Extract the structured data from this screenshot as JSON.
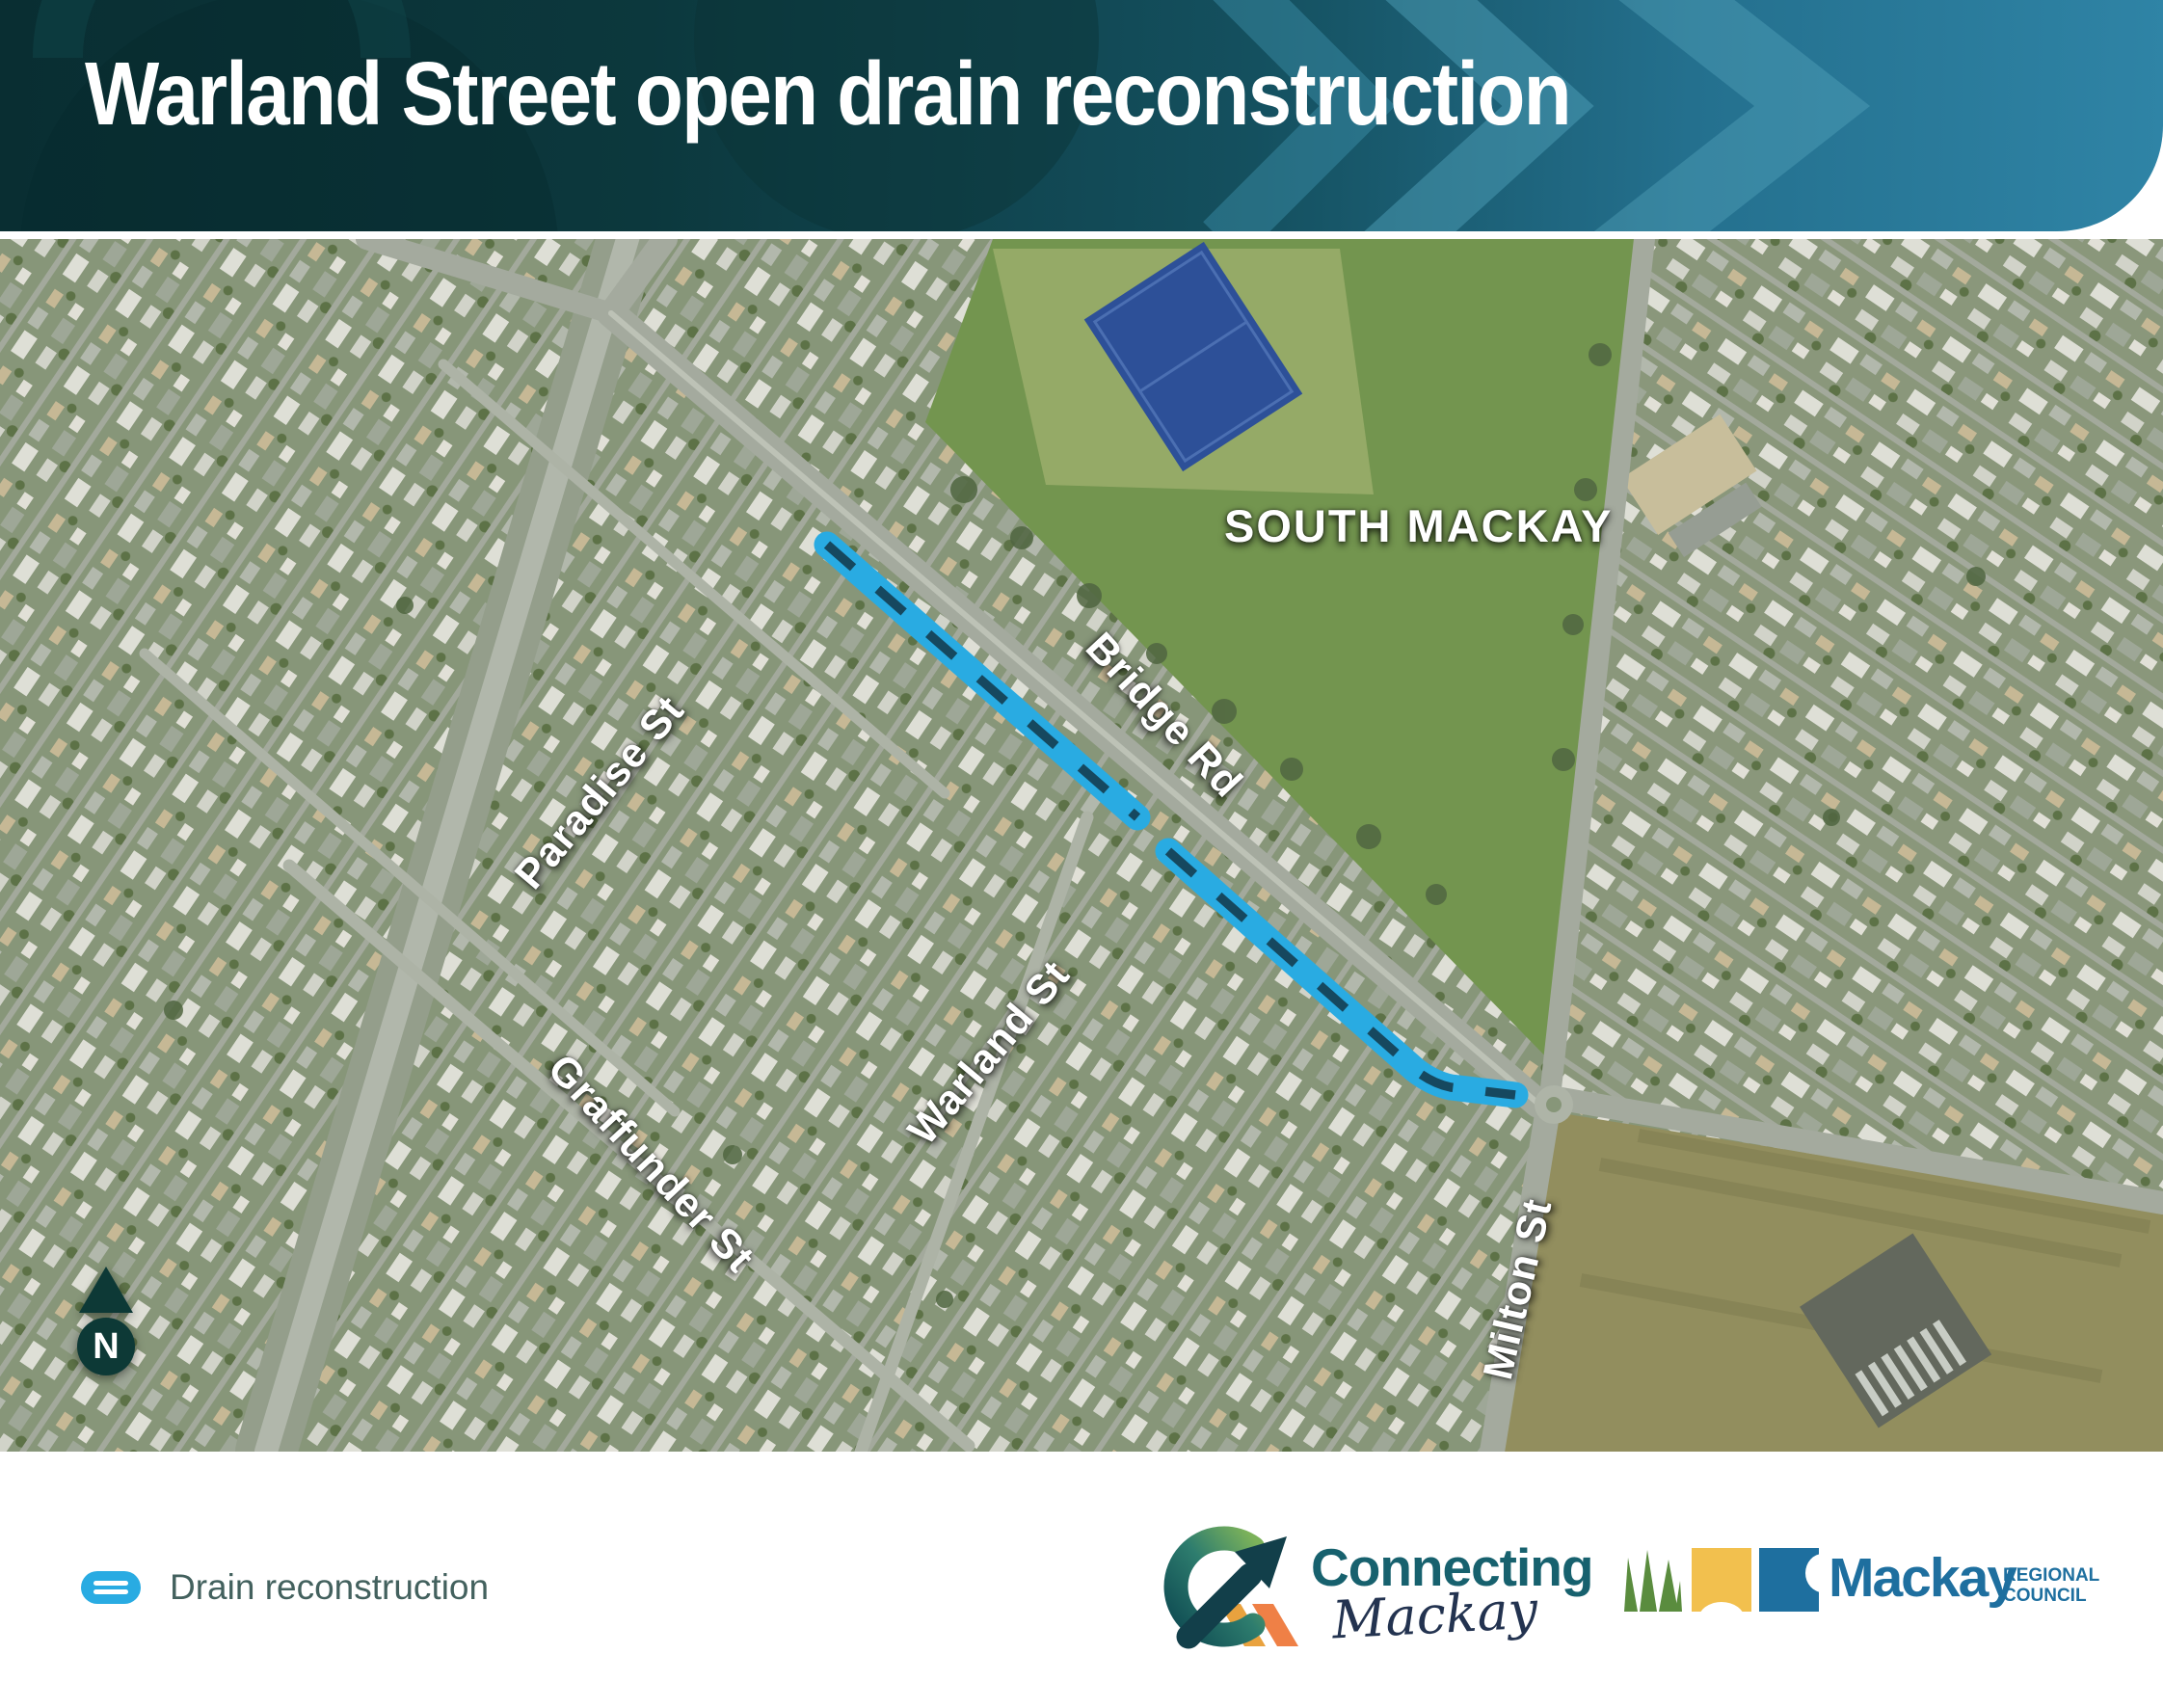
{
  "header": {
    "title": "Warland Street open drain reconstruction"
  },
  "map": {
    "region_label": "SOUTH MACKAY",
    "streets": [
      {
        "label": "Paradise St"
      },
      {
        "label": "Bridge Rd"
      },
      {
        "label": "Warland St"
      },
      {
        "label": "Graffunder St"
      },
      {
        "label": "Milton St"
      }
    ],
    "north_label": "N",
    "drain_color": "#29abe2"
  },
  "legend": {
    "drain_label": "Drain reconstruction"
  },
  "footer": {
    "connecting_mackay": {
      "word1": "Connecting",
      "word2": "Mackay"
    },
    "mackay_council": {
      "name": "Mackay",
      "regional": "REGIONAL",
      "council": "COUNCIL"
    }
  },
  "colors": {
    "header_dark": "#0b3438",
    "header_blue": "#2f84a6",
    "drain": "#29abe2",
    "north_arrow": "#0d3936",
    "legend_text": "#43615e",
    "connecting_teal": "#17616e",
    "council_blue": "#1e6f9f"
  }
}
